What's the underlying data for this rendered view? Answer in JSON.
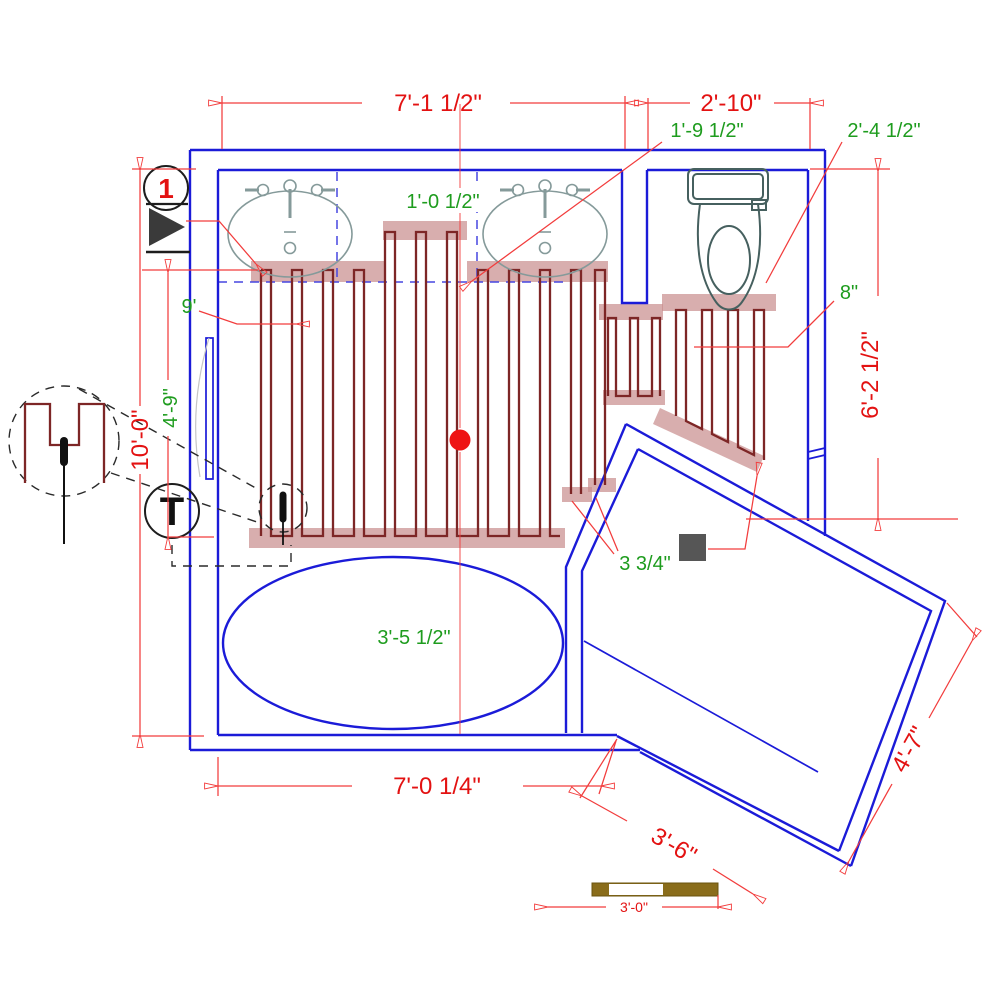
{
  "colors": {
    "wall_blue": "#1b1bd8",
    "pipe_dark_red": "#7d2626",
    "turn_band_salmon": "#c98f8f",
    "dimension_red": "#f23c3c",
    "text_red": "#e31212",
    "text_green": "#1e9c1e",
    "fixture_gray": "#859a9a",
    "scale_bar_brown": "#8a6d1b",
    "sensor_box_gray": "#565656"
  },
  "markers": {
    "detail_number": "1",
    "thermostat_label": "T"
  },
  "dimensions": {
    "top_width": "7'-1 1/2\"",
    "alcove_width": "2'-10\"",
    "vanity_offset": "1'-9 1/2\"",
    "toilet_center_offset": "2'-4 1/2\"",
    "loop_offset": "1'-0 1/2\"",
    "loop_start": "9'",
    "room_height": "10'-0\"",
    "vanity_depth": "4'-9\"",
    "alcove_height": "6'-2 1/2\"",
    "wall_gap": "8\"",
    "pipe_spacing": "3 3/4\"",
    "tub_centerline": "3'-5 1/2\"",
    "bottom_width": "7'-0 1/4\"",
    "shower_width": "3'-6\"",
    "shower_depth": "4'-7\"",
    "scale_length": "3'-0\""
  }
}
